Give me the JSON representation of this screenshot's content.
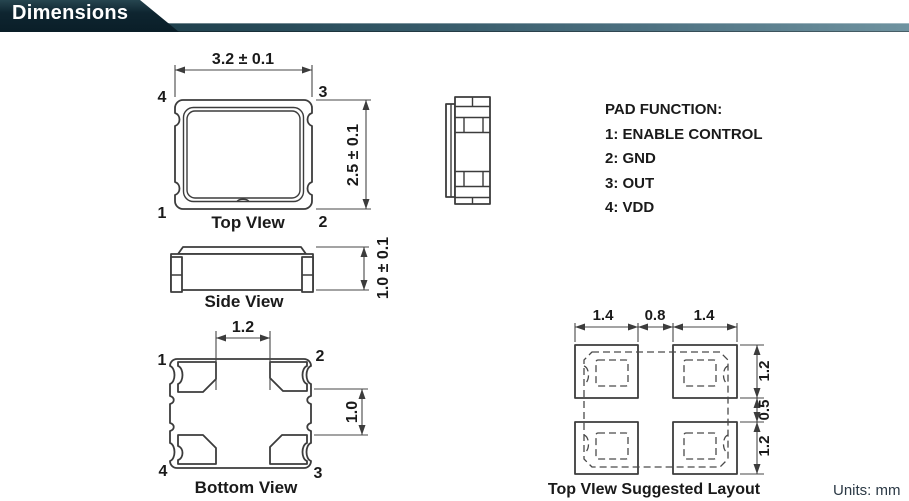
{
  "header": {
    "title": "Dimensions",
    "banner_color": "#0e2530",
    "bar_color": "#2b4f5d"
  },
  "footer": {
    "units": "Units: mm"
  },
  "pad_function": {
    "title": "PAD FUNCTION:",
    "item_1": "1: ENABLE CONTROL",
    "item_2": "2: GND",
    "item_3": "3: OUT",
    "item_4": "4: VDD"
  },
  "top_view": {
    "label": "Top VIew",
    "dim_width": "3.2 ± 0.1",
    "dim_height": "2.5 ± 0.1",
    "pin_top_left": "4",
    "pin_top_right": "3",
    "pin_bottom_left": "1",
    "pin_bottom_right": "2"
  },
  "side_view": {
    "label": "Side View",
    "dim_height": "1.0 ± 0.1"
  },
  "bottom_view": {
    "label": "Bottom View",
    "dim_pad_gap_width": "1.2",
    "dim_pad_gap_height": "1.0",
    "pin_top_left": "1",
    "pin_top_right": "2",
    "pin_bottom_left": "4",
    "pin_bottom_right": "3"
  },
  "suggested_layout": {
    "label": "Top VIew Suggested Layout",
    "dim_pad_width_left": "1.4",
    "dim_gap_width": "0.8",
    "dim_pad_width_right": "1.4",
    "dim_pad_height_top": "1.2",
    "dim_gap_height": "0.5",
    "dim_pad_height_bottom": "1.2"
  },
  "colors": {
    "line": "#3c3c3c",
    "text": "#1a1a1a"
  }
}
